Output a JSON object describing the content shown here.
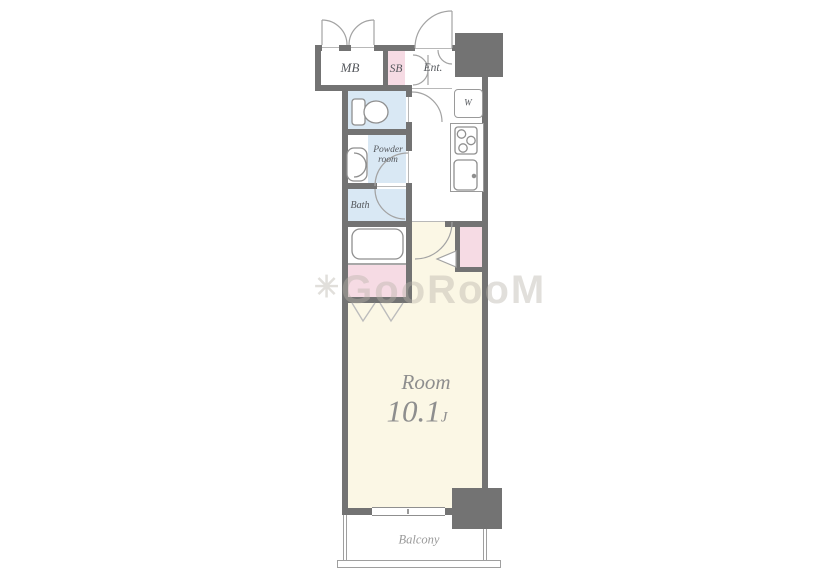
{
  "floorplan": {
    "type": "apartment-floor-plan",
    "watermark": {
      "icon": "✳",
      "text": "GooRooM"
    },
    "rooms": {
      "meter_box": "MB",
      "shoe_box": "SB",
      "entrance": "Ent.",
      "washer": "W",
      "powder_room_line1": "Powder",
      "powder_room_line2": "room",
      "bath": "Bath",
      "main_room_name": "Room",
      "main_room_area": "10.1",
      "main_room_area_unit": "J",
      "balcony": "Balcony"
    },
    "colors": {
      "wall": "#737373",
      "main_room_fill": "#FBF7E5",
      "wet_area_fill": "#D9E8F4",
      "closet_fill": "#F6DBE4",
      "fixture_stroke": "#8f8f8f",
      "door_arc_stroke": "#a3a3a3",
      "label_text": "#54575c",
      "room_label_text": "#8e8e8e"
    }
  }
}
